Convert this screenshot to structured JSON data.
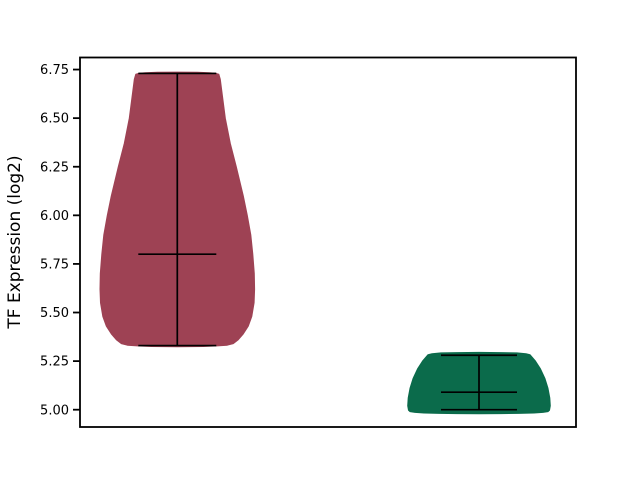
{
  "figure": {
    "width_px": 640,
    "height_px": 480,
    "background": "#ffffff"
  },
  "chart_data": {
    "type": "violin",
    "title": "",
    "xlabel": "",
    "ylabel": "TF Expression (log2)",
    "ylim": [
      4.911,
      6.812
    ],
    "grid": false,
    "legend": null,
    "axis_color": "#000000",
    "stat_line_color": "#000000",
    "axes_px": {
      "left": 80,
      "top": 57.5,
      "right": 576,
      "bottom": 427
    },
    "yticks": [
      6.75,
      6.5,
      6.25,
      6.0,
      5.75,
      5.5,
      5.25,
      5.0
    ],
    "ytick_labels": [
      "6.75",
      "6.50",
      "6.25",
      "6.00",
      "5.75",
      "5.50",
      "5.25",
      "5.00"
    ],
    "xticks": [],
    "xtick_labels": [],
    "series": [
      {
        "id": "violin-left",
        "fill": "#9e4254",
        "center_x_px": 177.3,
        "cap_halfwidth_px": 39,
        "stats": {
          "max": 6.73,
          "median": 5.8,
          "min": 5.33
        },
        "profile": [
          [
            6.737,
            0
          ],
          [
            6.736,
            20
          ],
          [
            6.734,
            32
          ],
          [
            6.731,
            38
          ],
          [
            6.726,
            41.5
          ],
          [
            6.7,
            43
          ],
          [
            6.64,
            44.5
          ],
          [
            6.5,
            48
          ],
          [
            6.37,
            53
          ],
          [
            6.25,
            59
          ],
          [
            6.1,
            66
          ],
          [
            6.0,
            70
          ],
          [
            5.9,
            73.5
          ],
          [
            5.8,
            75.5
          ],
          [
            5.7,
            77
          ],
          [
            5.62,
            77.3
          ],
          [
            5.55,
            76.8
          ],
          [
            5.48,
            74.5
          ],
          [
            5.43,
            71
          ],
          [
            5.39,
            66
          ],
          [
            5.36,
            61
          ],
          [
            5.34,
            56
          ],
          [
            5.332,
            50
          ],
          [
            5.328,
            40
          ],
          [
            5.325,
            26
          ],
          [
            5.324,
            0
          ]
        ]
      },
      {
        "id": "violin-right",
        "fill": "#0b6b4b",
        "center_x_px": 479,
        "cap_halfwidth_px": 38,
        "stats": {
          "max": 5.28,
          "median": 5.09,
          "min": 5.0
        },
        "profile": [
          [
            5.295,
            0
          ],
          [
            5.294,
            22
          ],
          [
            5.292,
            38
          ],
          [
            5.288,
            47
          ],
          [
            5.283,
            51
          ],
          [
            5.25,
            56.5
          ],
          [
            5.21,
            61.5
          ],
          [
            5.16,
            66
          ],
          [
            5.11,
            69
          ],
          [
            5.06,
            70.8
          ],
          [
            5.02,
            71.3
          ],
          [
            4.997,
            70.5
          ],
          [
            4.99,
            69
          ],
          [
            4.986,
            64
          ],
          [
            4.983,
            55
          ],
          [
            4.981,
            40
          ],
          [
            4.98,
            22
          ],
          [
            4.9795,
            0
          ]
        ]
      }
    ]
  }
}
